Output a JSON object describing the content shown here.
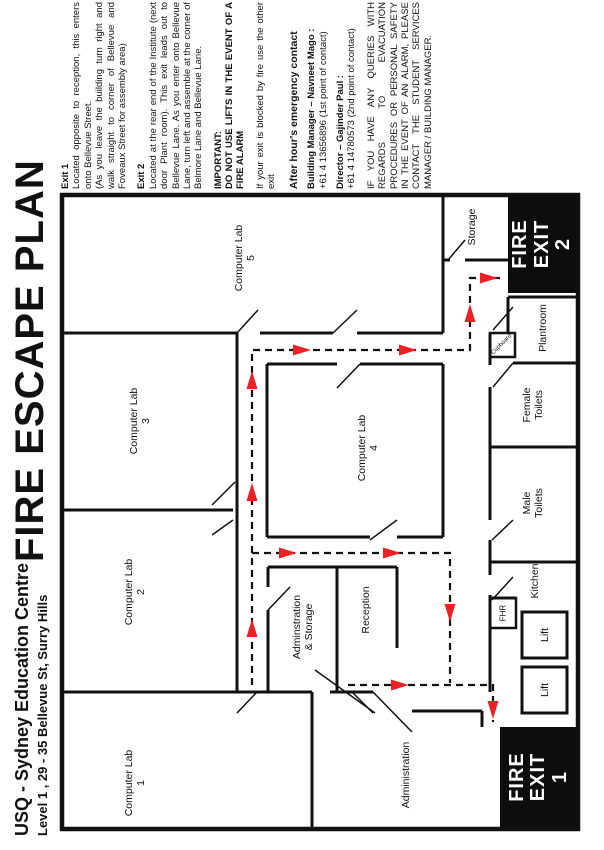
{
  "title": "FIRE ESCAPE PLAN",
  "subtitle": {
    "line1": "USQ - Sydney Education Centre",
    "line2": "Level 1 , 29 - 35 Bellevue St, Surry Hills"
  },
  "notes": {
    "exit1_heading": "Exit 1",
    "exit1_body": "Located opposite to reception, this enters onto Bellevue Street.",
    "exit1_note": "(As you leave the building turn right and walk straight to corner of Bellevue and Foveaux Street for assembly area)",
    "exit2_heading": "Exit 2",
    "exit2_body": "Located at the rear end of the Institute (next door Plant room). This exit leads out to Bellevue Lane. As you enter onto Bellevue Lane, turn left and assemble at the corner of Belmore Lane and Bellevue Lane.",
    "important_heading": "IMPORTANT:",
    "important_body": "DO NOT USE LIFTS IN THE EVENT OF A FIRE ALARM",
    "blocked_note": "If your exit is blocked by fire use the other exit",
    "after_hours_heading": "After hour's emergency contact",
    "contact1_name": "Building Manager – Navneet Mago :",
    "contact1_phone": "+61 4 13656896 (1st point of contact)",
    "contact2_name": "Director – Gajinder Paul :",
    "contact2_phone": "+61 4 14780573 (2nd point of contact)",
    "queries_note": "IF YOU HAVE ANY QUERIES WITH REGARDS TO EVACUATION PROCEDURES OR PERSONAL SAFETY IN THE EVENT OF AN ALARM, PLEASE CONTACT THE STUDENT SERVICES MANAGER / BUILDING MANAGER."
  },
  "rooms": {
    "lab1": [
      "Computer Lab",
      "1"
    ],
    "lab2": [
      "Computer Lab",
      "2"
    ],
    "lab3": [
      "Computer Lab",
      "3"
    ],
    "lab4": [
      "Computer Lab",
      "4"
    ],
    "lab5": [
      "Computer Lab",
      "5"
    ],
    "storage": [
      "Storage"
    ],
    "plantroom": [
      "Plantroom"
    ],
    "female_toilets": [
      "Female",
      "Toilets"
    ],
    "male_toilets": [
      "Male",
      "Toilets"
    ],
    "kitchen": [
      "Kitchen"
    ],
    "fhr": [
      "FHR"
    ],
    "lift_a": [
      "Lift"
    ],
    "lift_b": [
      "Lift"
    ],
    "admin_storage": [
      "Adminstration",
      "& Storage"
    ],
    "reception": [
      "Reception"
    ],
    "administration": [
      "Administration"
    ],
    "cupboard": [
      "Cupboard"
    ]
  },
  "exits": {
    "exit1": [
      "FIRE",
      "EXIT",
      "1"
    ],
    "exit2": [
      "FIRE",
      "EXIT",
      "2"
    ]
  },
  "colors": {
    "wall": "#111111",
    "route_red": "#ed2024"
  }
}
